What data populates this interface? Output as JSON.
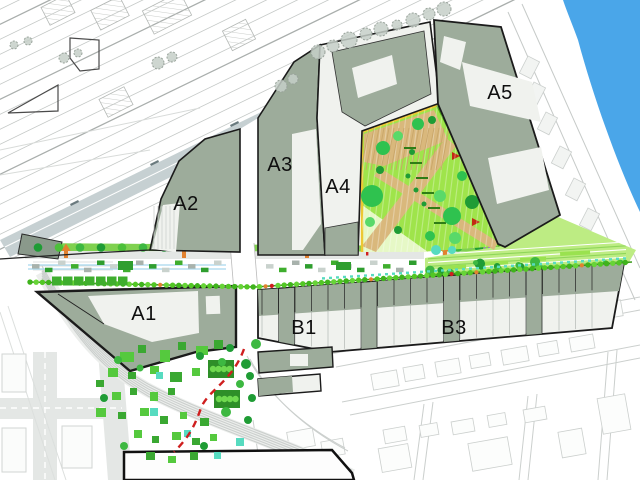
{
  "plan": {
    "type": "urban-masterplan-drawing",
    "labels": {
      "a1": "A1",
      "a2": "A2",
      "a3": "A3",
      "a4": "A4",
      "a5": "A5",
      "b1": "B1",
      "b3": "B3"
    }
  },
  "colors": {
    "block": "#9dac9b",
    "block_line": "#1b1b1b",
    "courtyard": "#f0f2ee",
    "water": "#4aa6e9",
    "park": "#9fe44b",
    "park_pale": "#e6f8c6",
    "garden": "#bdec83",
    "tan": "#d9b87c",
    "tree_dark": "#1f9c35",
    "tree_mid": "#3db841",
    "tree_light": "#6fd94f",
    "teal": "#57dbc0",
    "hedge": "#52c724",
    "strip_green": "#7fd14f",
    "road": "#e4e7e5",
    "rail": "#c4c8c6",
    "platform": "#c6d0d2",
    "orange": "#e2812f",
    "red": "#cf1f1f",
    "purple": "#a06cd5",
    "faint": "#cbcfcd",
    "sketch": "#c6cfc8",
    "cycle": "#a8d8ee",
    "west_head": "#8a998b"
  }
}
